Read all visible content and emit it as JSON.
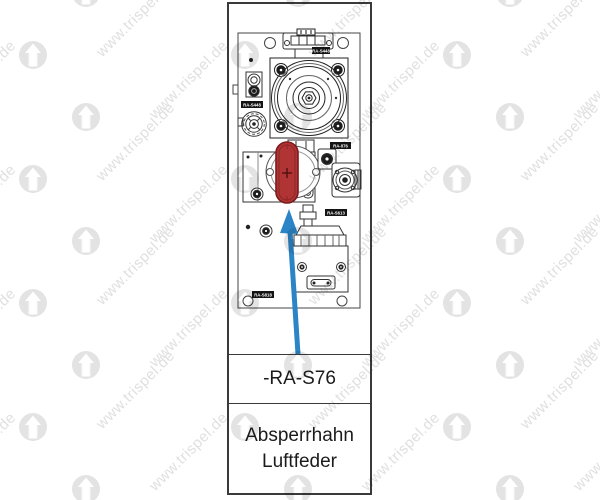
{
  "watermark": {
    "text": "www.trispel.de",
    "logo": "up-arrow-logo"
  },
  "panel": {
    "tag_label": "-RA-S76",
    "description": [
      "Absperrhahn",
      "Luftfeder"
    ],
    "badges": {
      "top": "RA-S448",
      "left": "RA-S448",
      "right": "RA-876",
      "mid_right": "RA-S613",
      "bottom_left": "RA-S818"
    }
  },
  "colors": {
    "highlight_red": "#b13434",
    "arrow_blue": "#2b84c5",
    "watermark_gray": "#e0e0e0",
    "line_dark": "#333333"
  }
}
